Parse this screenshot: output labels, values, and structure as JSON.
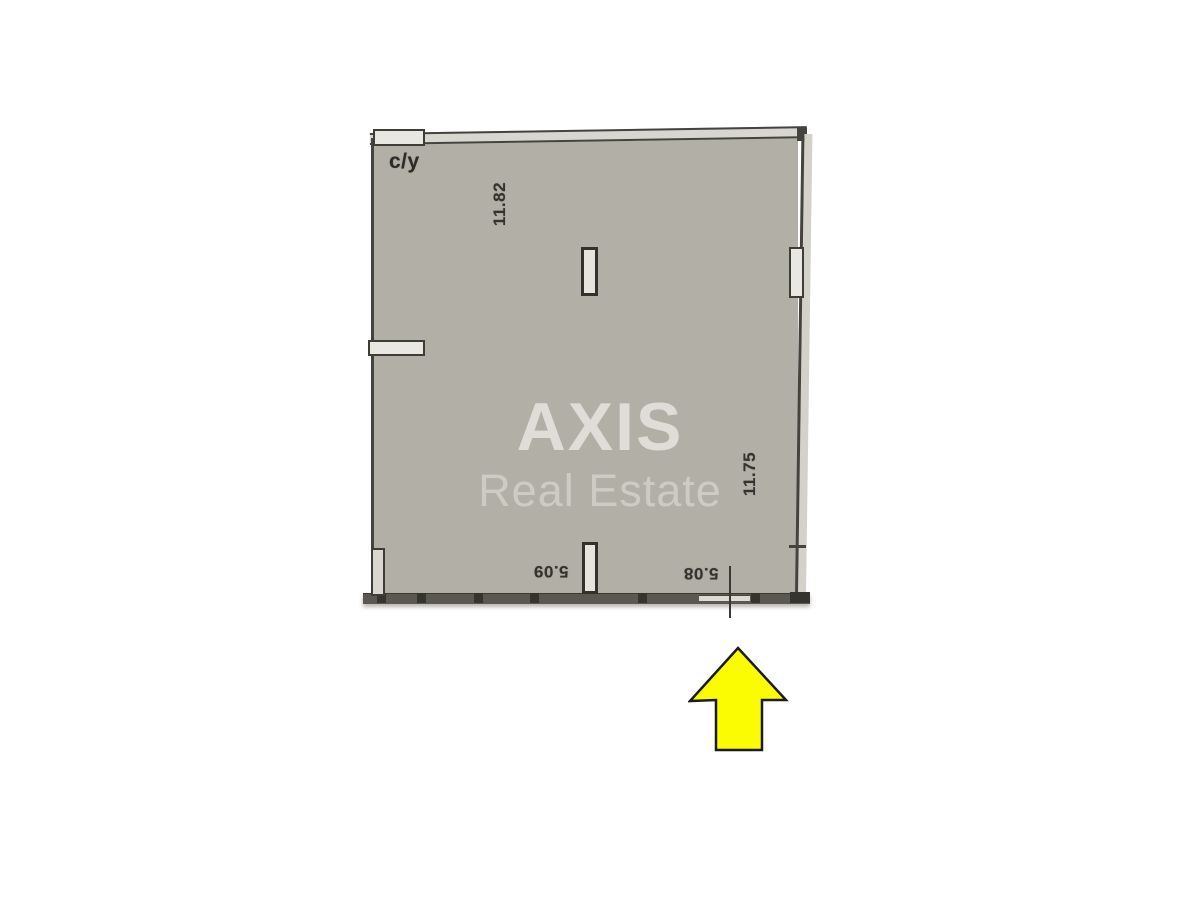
{
  "watermark": {
    "brand": "AXIS",
    "tagline": "Real Estate"
  },
  "floorplan": {
    "room_label": "c/y",
    "dimensions": {
      "top": "11.82",
      "right": "11.75",
      "bottom_left": "5.09",
      "bottom_right": "5.08"
    }
  },
  "icons": {
    "entrance_marker": "up-arrow-icon"
  },
  "colors": {
    "page_bg": "#ffffff",
    "floor_fill": "#b2afa7",
    "wall_line": "#45433e",
    "wall_band": "#5b5852",
    "wall_band_tick": "#36342f",
    "wall_light_fill": "#e9e7e1",
    "top_wall_fill": "#d8d6d0",
    "watermark_brand": "#deddd7",
    "watermark_tagline": "#cecbc4",
    "dimension_text": "#34332e",
    "arrow_fill": "#fbfb02",
    "arrow_outline": "#1b1b1b"
  }
}
